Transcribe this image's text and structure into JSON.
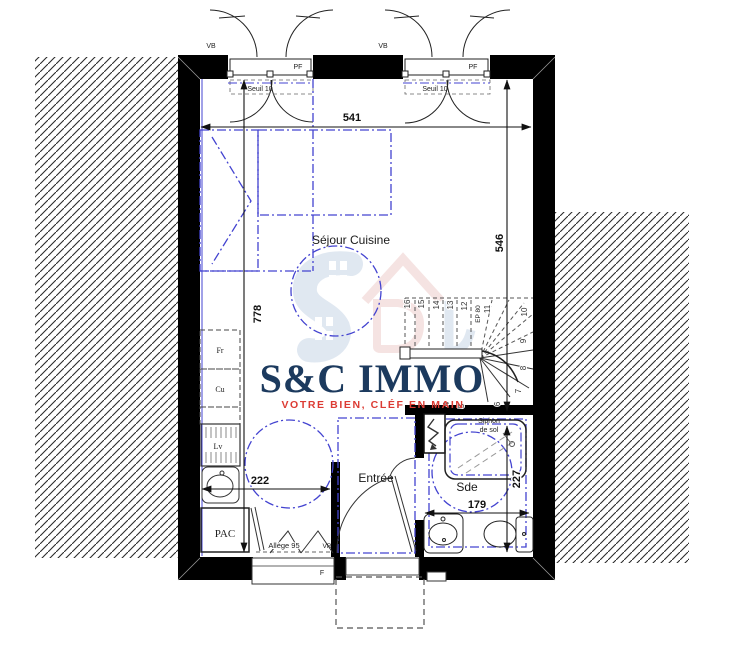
{
  "branding": {
    "name": "S&C IMMO",
    "tagline": "VOTRE BIEN, CLÉF EN MAIN",
    "logo_color": "#1c3a5e",
    "tagline_color": "#dc3b33"
  },
  "rooms": {
    "sejour": "Séjour Cuisine",
    "entree": "Entrée",
    "sde": "Sde"
  },
  "dims": {
    "width_top": "541",
    "height_right": "546",
    "height_left": "778",
    "kitchen_width": "222",
    "sde_height": "227",
    "sde_width": "179"
  },
  "openings": {
    "pf": "PF",
    "vb": "VB",
    "seuil": "Seuil 10",
    "window_f": "F",
    "vr": "VR",
    "allege": "Allège 95"
  },
  "kitchen": {
    "fridge": "Fr",
    "cooker": "Cu",
    "dishwasher": "Lv",
    "heat_pump": "PAC"
  },
  "bath": {
    "siphon_line1": "Siphon",
    "siphon_line2": "de sol"
  },
  "stairs": {
    "ep": "EP 80",
    "numbers": [
      "16",
      "15",
      "14",
      "13",
      "12",
      "11",
      "10",
      "9",
      "8",
      "7",
      "4",
      "5",
      "6"
    ]
  },
  "colors": {
    "wall": "#000000",
    "annotation_blue": "#4343d0",
    "watermark_blue": "#c3d2e5",
    "watermark_pink": "#edc9c6"
  }
}
